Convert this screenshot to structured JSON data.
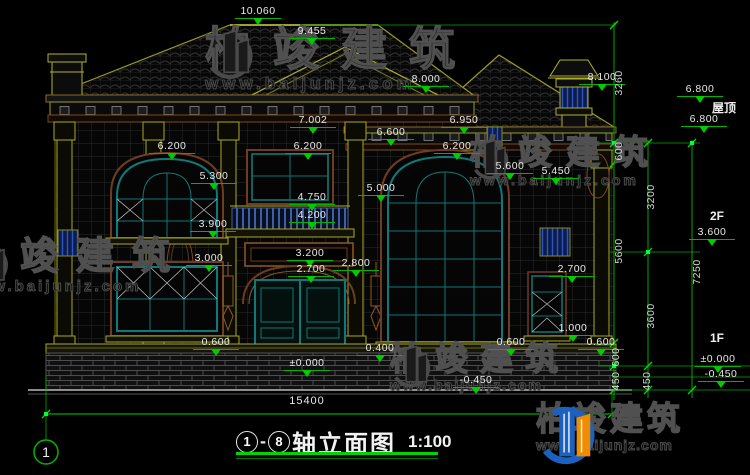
{
  "watermark": {
    "brand": "柏竣建筑",
    "url": "www.baijunjz.com",
    "logo_icon": "baijun-building-logo"
  },
  "title_block": {
    "axis_start": "1",
    "axis_separator": "-",
    "axis_end": "8",
    "name": "轴立面图",
    "scale": "1:100"
  },
  "axis_bubble": {
    "label": "1"
  },
  "drawing": {
    "overall_width": {
      "label": "15400",
      "x": 307,
      "y": 395
    },
    "level_texts": [
      {
        "label": "屋顶",
        "x": 724,
        "y": 99
      },
      {
        "label": "2F",
        "x": 717,
        "y": 209
      },
      {
        "label": "1F",
        "x": 717,
        "y": 331
      }
    ],
    "elevation_marks": [
      {
        "label": "10.060",
        "x": 258,
        "y": 6
      },
      {
        "label": "9.455",
        "x": 312,
        "y": 26
      },
      {
        "label": "8.000",
        "x": 426,
        "y": 74
      },
      {
        "label": "8.100",
        "x": 602,
        "y": 72
      },
      {
        "label": "7.002",
        "x": 313,
        "y": 115
      },
      {
        "label": "6.950",
        "x": 464,
        "y": 115
      },
      {
        "label": "6.600",
        "x": 391,
        "y": 127
      },
      {
        "label": "6.200",
        "x": 172,
        "y": 141
      },
      {
        "label": "6.200",
        "x": 308,
        "y": 141
      },
      {
        "label": "6.200",
        "x": 457,
        "y": 141
      },
      {
        "label": "5.600",
        "x": 510,
        "y": 161
      },
      {
        "label": "5.450",
        "x": 556,
        "y": 166
      },
      {
        "label": "5.300",
        "x": 214,
        "y": 171
      },
      {
        "label": "5.000",
        "x": 381,
        "y": 183
      },
      {
        "label": "4.750",
        "x": 312,
        "y": 192
      },
      {
        "label": "4.200",
        "x": 312,
        "y": 210
      },
      {
        "label": "3.900",
        "x": 213,
        "y": 219
      },
      {
        "label": "3.200",
        "x": 310,
        "y": 248
      },
      {
        "label": "3.000",
        "x": 209,
        "y": 253
      },
      {
        "label": "2.800",
        "x": 356,
        "y": 258
      },
      {
        "label": "2.700",
        "x": 311,
        "y": 264
      },
      {
        "label": "2.700",
        "x": 572,
        "y": 264
      },
      {
        "label": "1.000",
        "x": 573,
        "y": 323
      },
      {
        "label": "0.600",
        "x": 216,
        "y": 337
      },
      {
        "label": "0.600",
        "x": 511,
        "y": 337
      },
      {
        "label": "0.600",
        "x": 601,
        "y": 337
      },
      {
        "label": "0.400",
        "x": 380,
        "y": 343
      },
      {
        "label": "±0.000",
        "x": 307,
        "y": 358
      },
      {
        "label": "-0.450",
        "x": 476,
        "y": 375
      },
      {
        "label": "6.800",
        "x": 700,
        "y": 84
      },
      {
        "label": "6.800",
        "x": 704,
        "y": 114
      },
      {
        "label": "3.600",
        "x": 712,
        "y": 227
      },
      {
        "label": "±0.000",
        "x": 718,
        "y": 354
      },
      {
        "label": "-0.450",
        "x": 721,
        "y": 369
      }
    ],
    "chain_dims": [
      {
        "label": "3260",
        "x": 619,
        "y": 83
      },
      {
        "label": "600",
        "x": 619,
        "y": 151
      },
      {
        "label": "5600",
        "x": 619,
        "y": 251
      },
      {
        "label": "600",
        "x": 616,
        "y": 357
      },
      {
        "label": "450",
        "x": 616,
        "y": 381
      },
      {
        "label": "3200",
        "x": 651,
        "y": 197
      },
      {
        "label": "3600",
        "x": 651,
        "y": 316
      },
      {
        "label": "450",
        "x": 647,
        "y": 381
      },
      {
        "label": "7250",
        "x": 697,
        "y": 272
      }
    ]
  }
}
